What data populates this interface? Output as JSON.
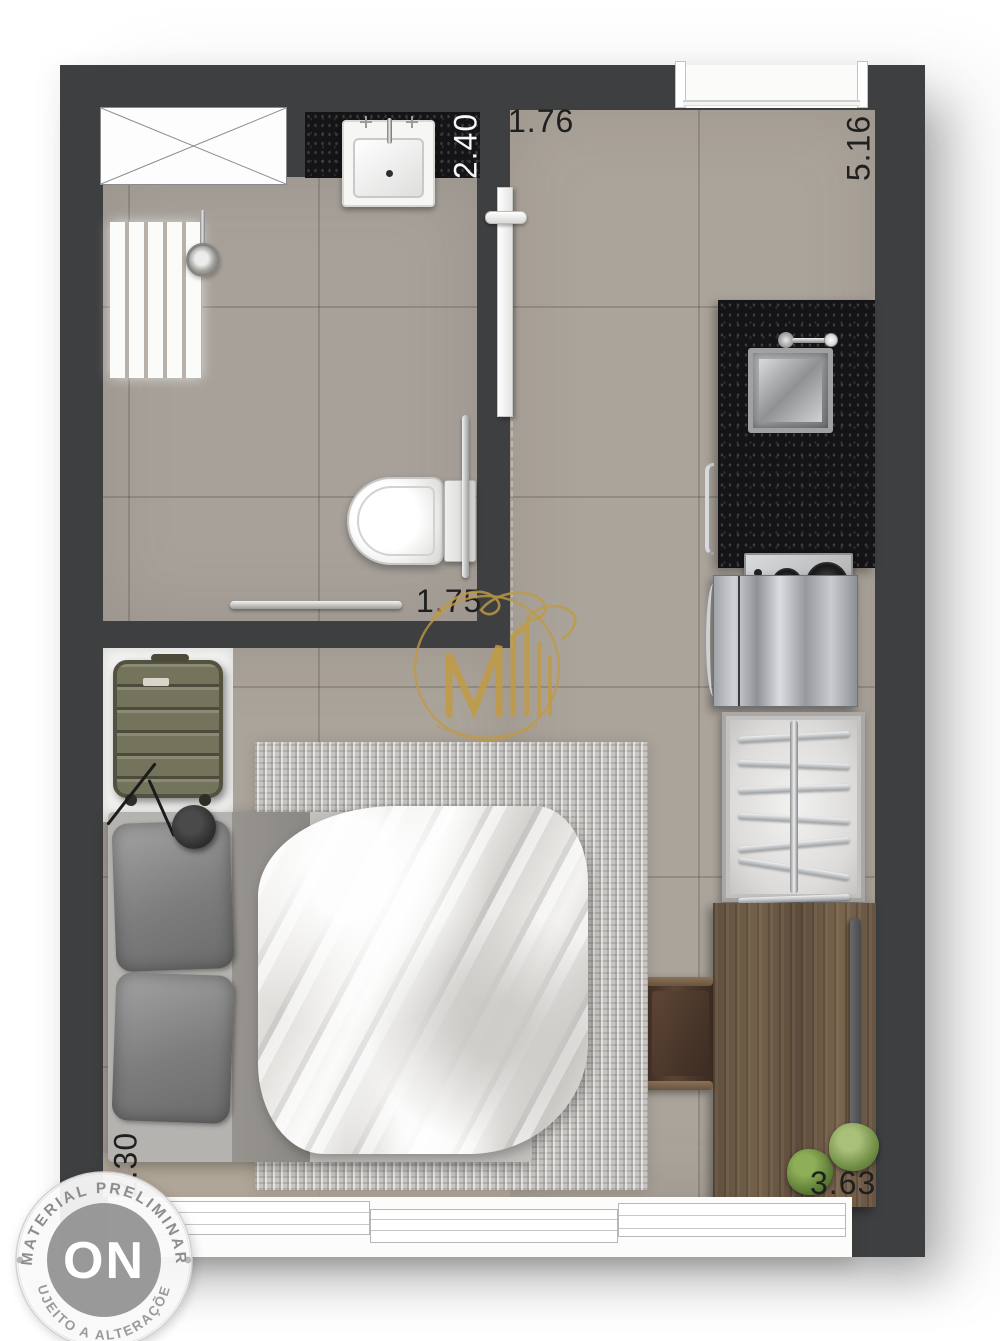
{
  "dimensions": {
    "bathroom_width": "2.40",
    "entry": "1.76",
    "side_length": "5.16",
    "bathroom_length": "1.75",
    "bed_wall": "2.30",
    "window_wall": "3.63"
  },
  "preliminary_stamp": {
    "arc_top": "MATERIAL PRELIMINAR",
    "center": "ON",
    "arc_bottom": "SUJEITO A ALTERAÇÕES"
  },
  "watermark": {
    "color": "#c09a44"
  },
  "colors": {
    "wall": "#3e3f41",
    "floor": "#aba49b",
    "floor_bath": "#a7a19a",
    "granite": "#141417",
    "wood": "#6e5a45",
    "gold": "#c09a44",
    "suitcase": "#74735c",
    "rug": "#c7c5c1",
    "stamp_gray": "#8f8f8f",
    "plant_green": "#6b8a42"
  }
}
